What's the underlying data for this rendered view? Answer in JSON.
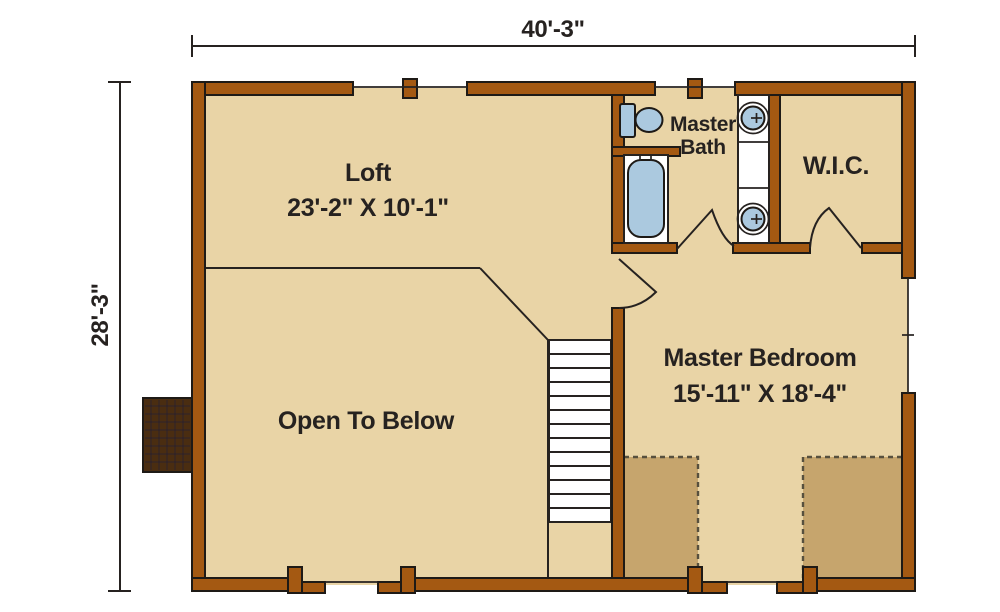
{
  "dims": {
    "width": "40'-3\"",
    "height": "28'-3\""
  },
  "rooms": {
    "loft": {
      "label": "Loft",
      "size": "23'-2\" X 10'-1\""
    },
    "master_bath": {
      "label_line1": "Master",
      "label_line2": "Bath"
    },
    "wic": {
      "label": "W.I.C."
    },
    "master_bedroom": {
      "label": "Master Bedroom",
      "size": "15'-11\" X 18'-4\""
    },
    "open_to_below": {
      "label": "Open To Below"
    }
  },
  "fixtures": {
    "toilet": "toilet",
    "bathtub": "bathtub",
    "vanity_sinks": "double-round-sinks",
    "staircase": "staircase-13-treads",
    "chimney": "masonry-chimney",
    "doors": [
      "master-bath-door",
      "wic-door",
      "master-bedroom-door"
    ],
    "attic_zones": "low-ceiling-dashed-areas"
  },
  "colors": {
    "wall": "#A45912",
    "outline": "#1E1A16",
    "floor": "#E9D4A6",
    "attic": "#C6A56D",
    "fixture": "#ABC9DF",
    "chimney": "#4A2D11",
    "line": "#262220",
    "dashed": "#57503E",
    "text": "#262220",
    "bg": "#FFFFFF"
  }
}
